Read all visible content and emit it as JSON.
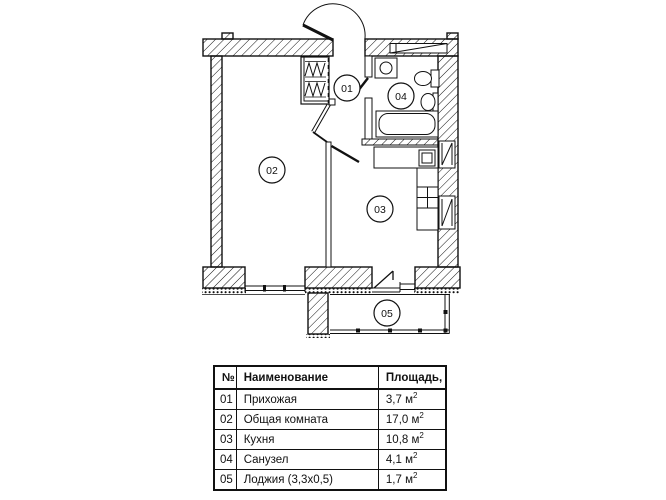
{
  "plan": {
    "labels": {
      "r01": "01",
      "r02": "02",
      "r03": "03",
      "r04": "04",
      "r05": "05"
    }
  },
  "table": {
    "sup": "2",
    "headers": {
      "num": "№",
      "name": "Наименование",
      "area": "Площадь, м"
    },
    "rows": [
      {
        "num": "01",
        "name": "Прихожая",
        "area": "3,7 м"
      },
      {
        "num": "02",
        "name": "Общая комната",
        "area": "17,0 м"
      },
      {
        "num": "03",
        "name": "Кухня",
        "area": "10,8 м"
      },
      {
        "num": "04",
        "name": "Санузел",
        "area": "4,1 м"
      },
      {
        "num": "05",
        "name": "Лоджия (3,3х0,5)",
        "area": "1,7 м"
      }
    ]
  },
  "colors": {
    "line": "#111111",
    "background": "#ffffff"
  }
}
